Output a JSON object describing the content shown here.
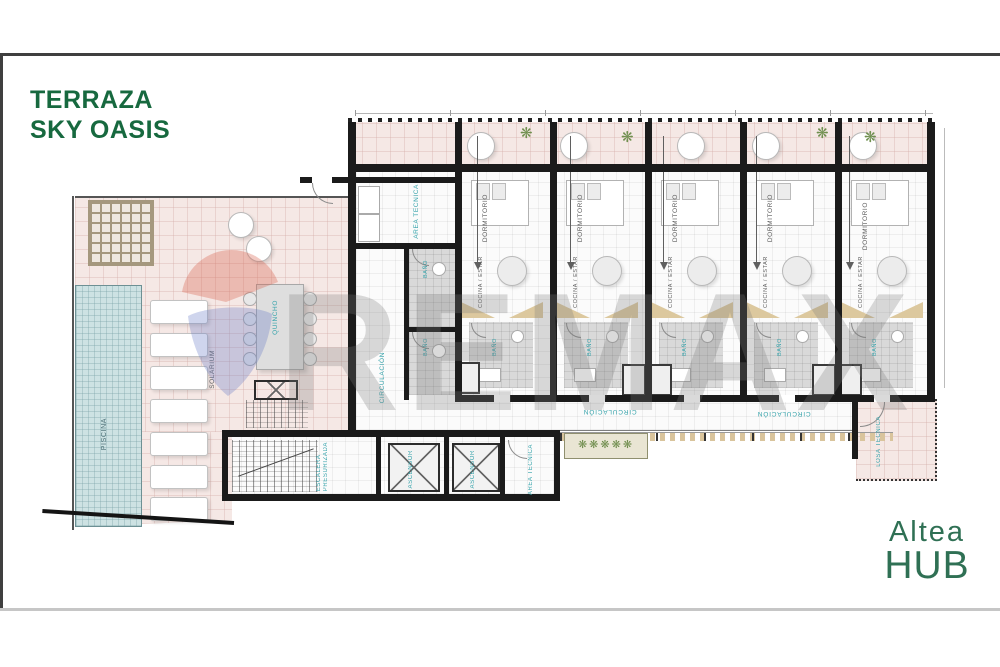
{
  "page": {
    "title_line1": "TERRAZA",
    "title_line2": "SKY OASIS"
  },
  "brand": {
    "line1": "Altea",
    "line2": "HUB"
  },
  "watermark": {
    "text": "REMAX"
  },
  "icons": {
    "plant": "❋"
  },
  "plan": {
    "amenities": {
      "piscina": "PISCINA",
      "solarium": "SOLARIUM",
      "quincho": "QUINCHO"
    },
    "core": {
      "area_tecnica": "AREA TECNICA",
      "circulacion": "CIRCULACIÓN",
      "bano_1": "BAÑO",
      "bano_2": "BAÑO"
    },
    "units": [
      {
        "dormitorio": "DORMITORIO",
        "cocina": "COCINA / ESTAR",
        "mono": "MONOAMBIENTE",
        "bano": "BAÑO"
      },
      {
        "dormitorio": "DORMITORIO",
        "cocina": "COCINA / ESTAR",
        "mono": "MONOAMBIENTE",
        "bano": "BAÑO"
      },
      {
        "dormitorio": "DORMITORIO",
        "cocina": "COCINA / ESTAR",
        "mono": "MONOAMBIENTE",
        "bano": "BAÑO"
      },
      {
        "dormitorio": "DORMITORIO",
        "cocina": "COCINA / ESTAR",
        "mono": "MONOAMBIENTE",
        "bano": "BAÑO"
      },
      {
        "dormitorio": "DORMITORIO",
        "cocina": "COCINA / ESTAR",
        "mono": "MONOAMBIENTE",
        "bano": "BAÑO"
      }
    ],
    "corridor": {
      "circulacion_1": "CIRCULACIÓN",
      "circulacion_2": "CIRCULACIÓN"
    },
    "services": {
      "escalera_line1": "ESCALERA",
      "escalera_line2": "PRESURIZADA",
      "ascensor_1": "ASCENSOR",
      "ascensor_2": "ASCENSOR",
      "area_tecnica": "AREA TECNICA",
      "losa_tecnica": "LOSA TECNICA"
    }
  },
  "colors": {
    "title_green": "#17693f",
    "brand_green": "#2f7054",
    "label_teal": "#35a3ab",
    "label_gray": "#5d5d5d",
    "wall_black": "#1b1b1b",
    "terrace_pink": "#f5e8e5",
    "pool_blue": "#cde2e3",
    "counter_tan": "#dcc89e",
    "watermark_gray": "rgba(122,122,122,0.28)",
    "balloon_red": "#d9604c",
    "balloon_blue": "#6478c3",
    "frame_dark": "#3f3f3f",
    "frame_light": "#c6c6c6"
  }
}
